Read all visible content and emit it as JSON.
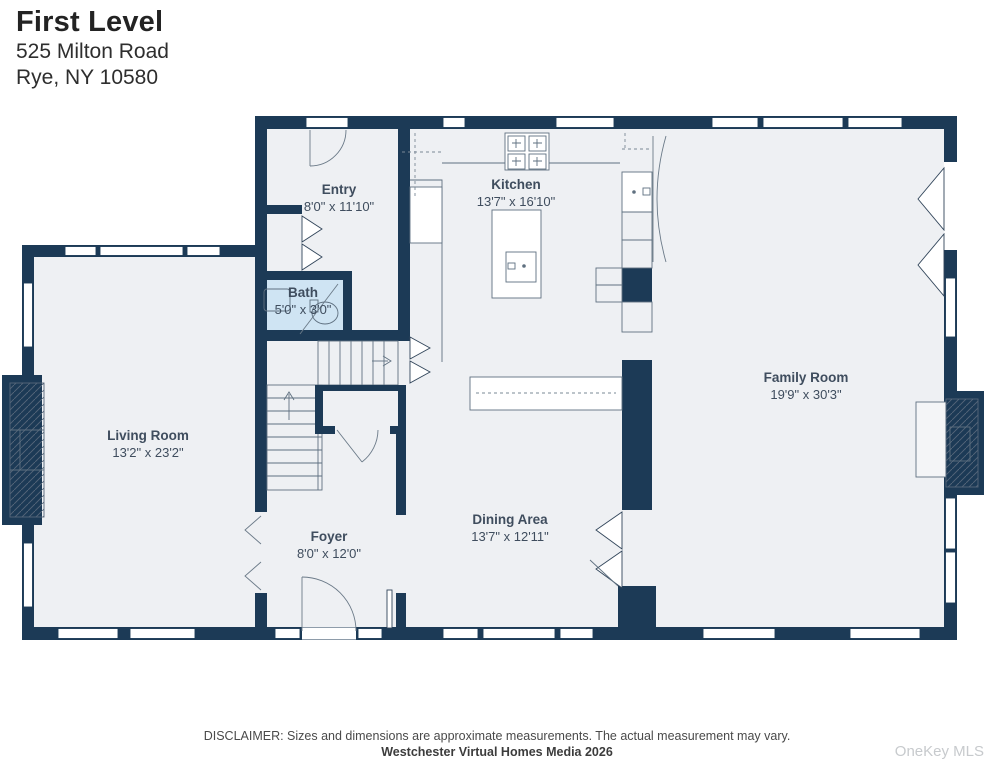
{
  "header": {
    "title": "First Level",
    "address_line1": "525 Milton Road",
    "address_line2": "Rye, NY 10580"
  },
  "rooms": [
    {
      "name": "Entry",
      "dims": "8'0\" x 11'10\""
    },
    {
      "name": "Kitchen",
      "dims": "13'7\" x 16'10\""
    },
    {
      "name": "Bath",
      "dims": "5'0\" x 3'0\""
    },
    {
      "name": "Living Room",
      "dims": "13'2\" x 23'2\""
    },
    {
      "name": "Family Room",
      "dims": "19'9\" x 30'3\""
    },
    {
      "name": "Foyer",
      "dims": "8'0\" x 12'0\""
    },
    {
      "name": "Dining Area",
      "dims": "13'7\" x 12'11\""
    }
  ],
  "footer": {
    "disclaimer": "DISCLAIMER: Sizes and dimensions are approximate measurements. The actual measurement may vary.",
    "credit": "Westchester Virtual Homes Media 2026",
    "watermark": "OneKey MLS"
  },
  "colors": {
    "wall": "#1c3a56",
    "floor": "#eef0f3",
    "bath_floor": "#cfe4f3",
    "label_text": "#3f4d5e"
  }
}
